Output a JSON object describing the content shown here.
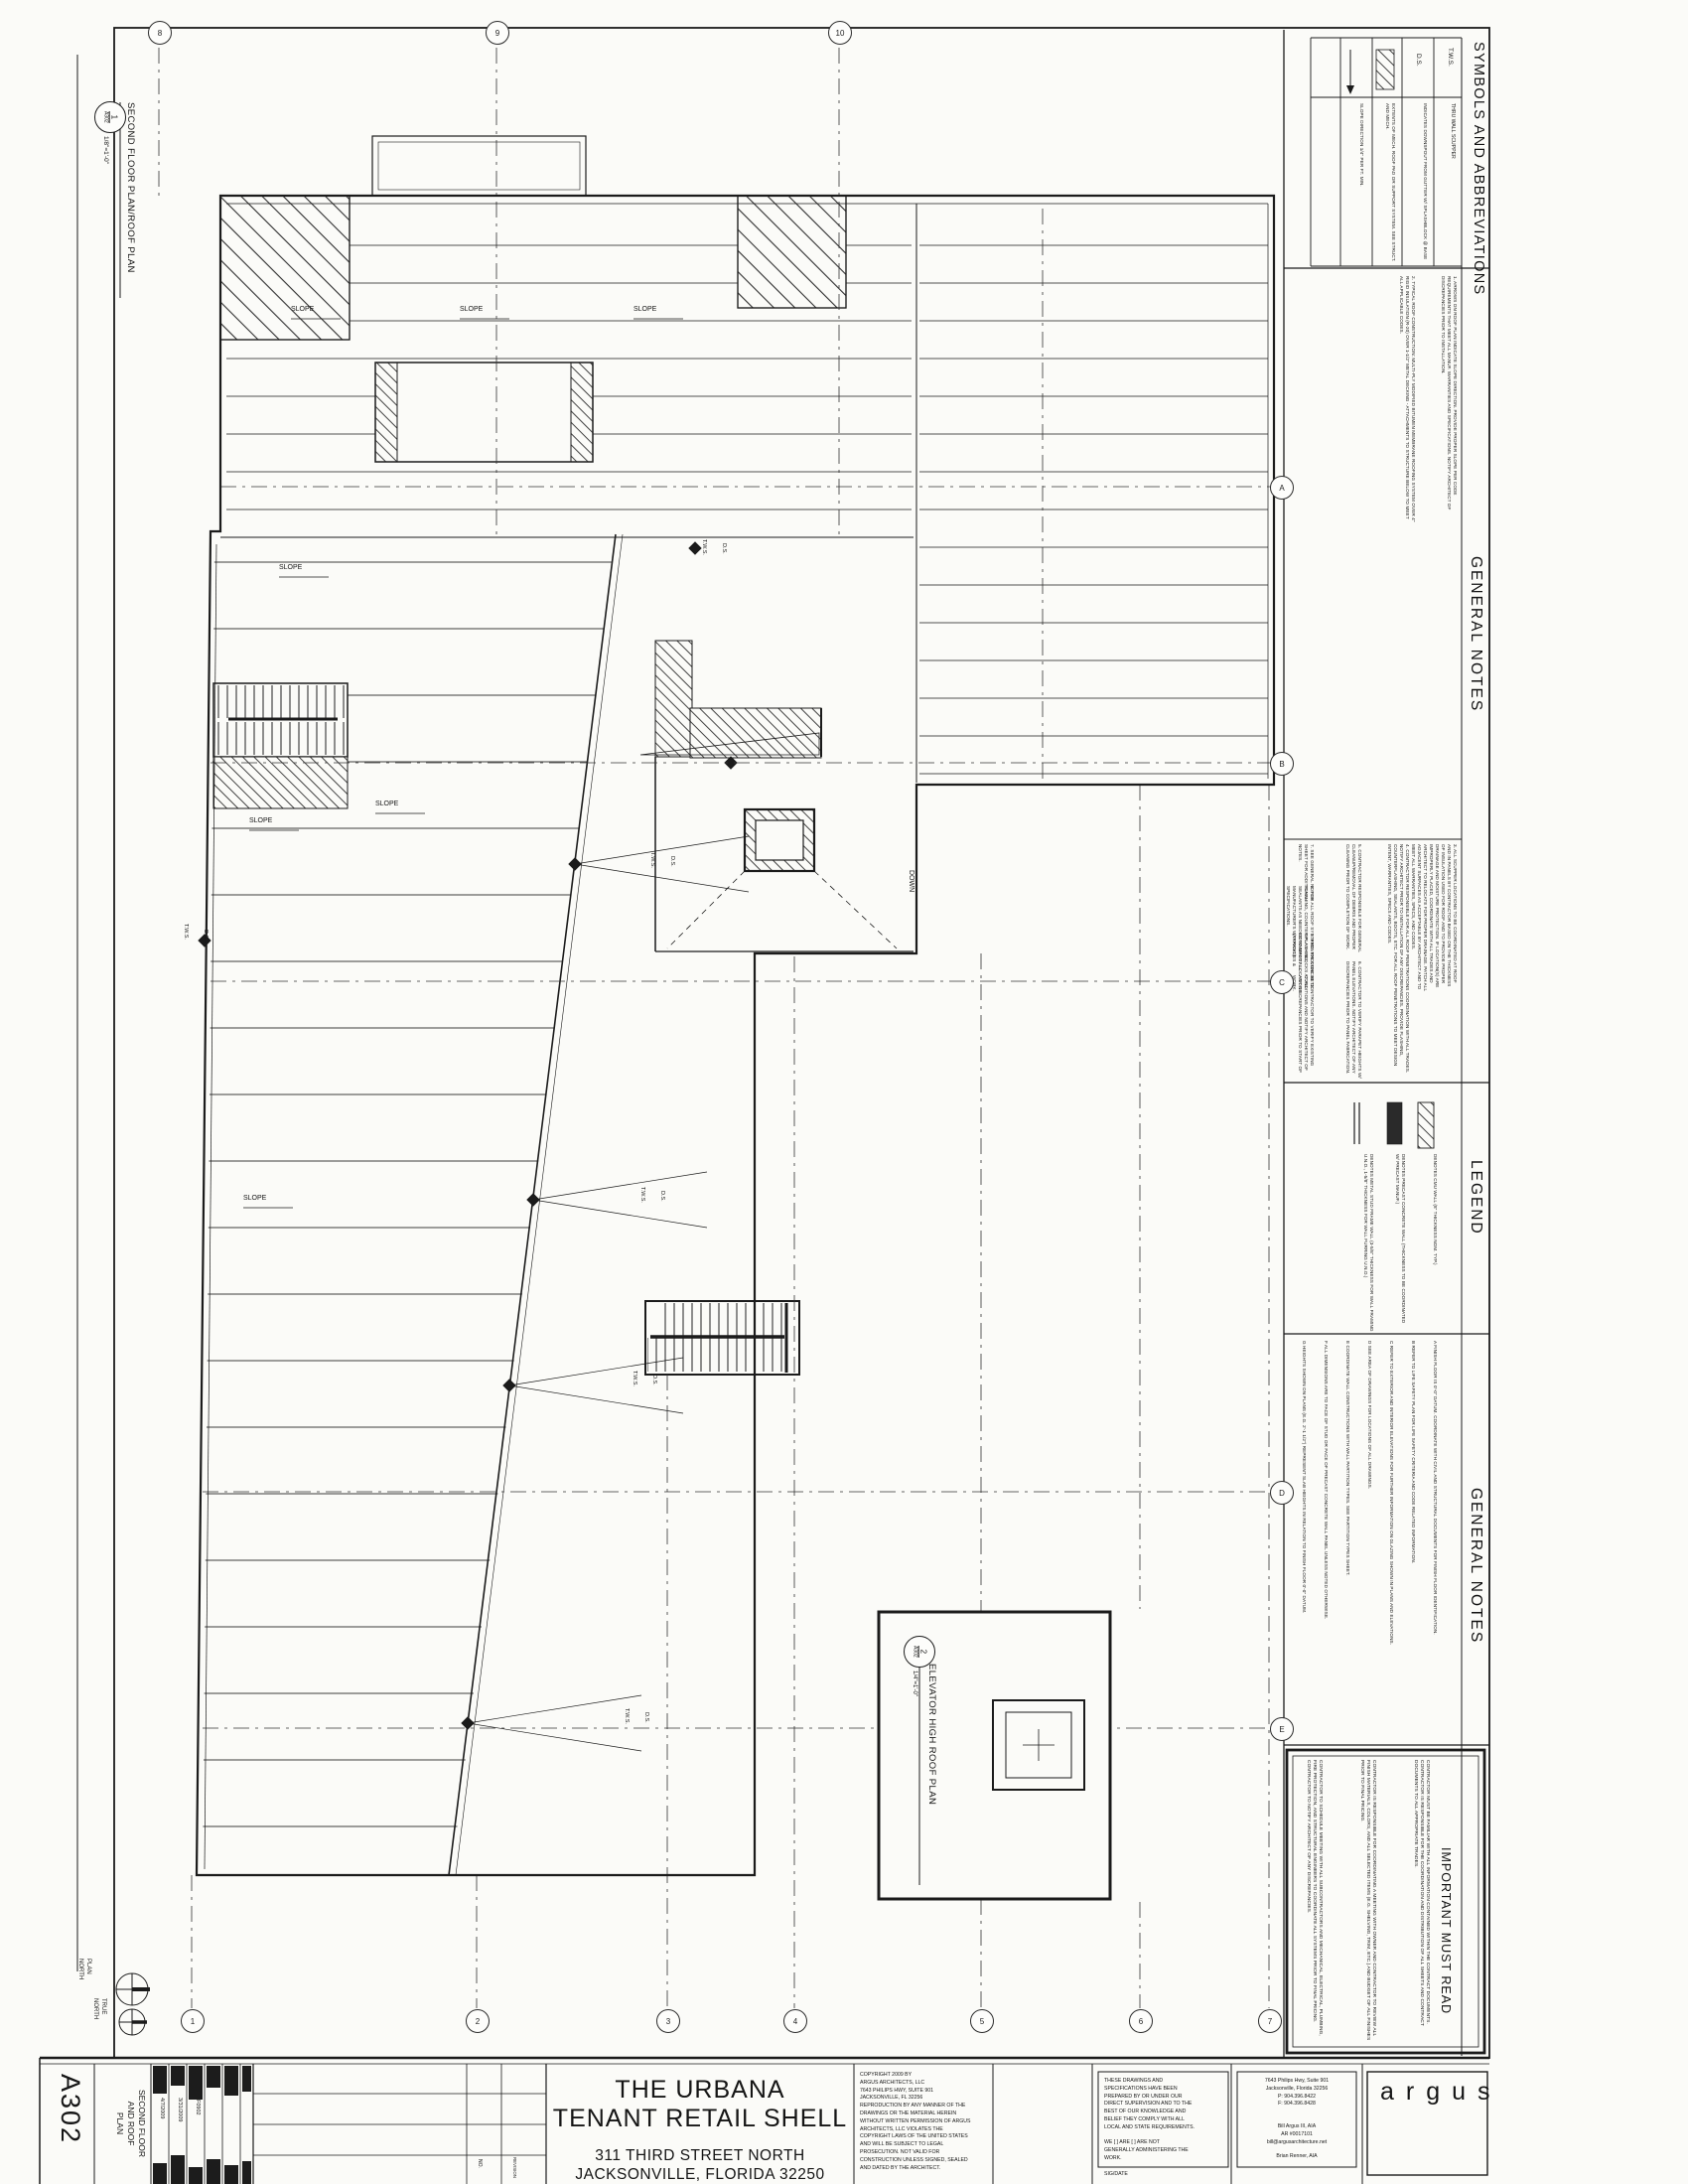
{
  "sheet_meta": {
    "sheet_number": "A302",
    "sheet_title": "SECOND FLOOR\nAND ROOF\nPLAN",
    "date_1": "4/7/2009",
    "date_2": "3/31/2009",
    "project_number": "F0902",
    "rev_no_label": "NO.",
    "rev_label": "REVISION"
  },
  "project": {
    "title_line_1": "THE URBANA",
    "title_line_2": "TENANT RETAIL SHELL",
    "address_line_1": "311 THIRD STREET NORTH",
    "address_line_2": "JACKSONVILLE, FLORIDA 32250"
  },
  "firm": {
    "logo": "argus",
    "address": "7643 Philips Hwy, Suite 901\nJacksonville, Florida 32256\nP: 904.396.8422\nF: 904.396.8428",
    "principal": "Bill Argus III, AIA\nAR #0017101\nbill@argusarchitecture.net",
    "associate": "Brian Renner, AIA",
    "copyright": "COPYRIGHT 2009 BY\nARGUS ARCHITECTS, LLC\n7643 PHILIPS HWY, SUITE 901\nJACKSONVILLE, FL  32256\nREPRODUCTION BY ANY MANNER OF THE\nDRAWINGS OR THE MATERIAL HEREIN\nWITHOUT WRITTEN PERMISSION OF ARGUS\nARCHITECTS, LLC VIOLATES THE\nCOPYRIGHT LAWS OF THE UNITED STATES\nAND WILL BE SUBJECT TO LEGAL\nPROSECUTION.  NOT VALID FOR\nCONSTRUCTION UNLESS SIGNED, SEALED\nAND DATED BY THE ARCHITECT.",
    "certification": "THESE DRAWINGS AND\nSPECIFICATIONS HAVE BEEN\nPREPARED BY OR UNDER OUR\nDIRECT SUPERVISION AND TO THE\nBEST OF OUR KNOWLEDGE AND\nBELIEF THEY COMPLY WITH ALL\nLOCAL AND STATE REQUIREMENTS.\n\nWE [    ] ARE [    ] ARE NOT\nGENERALLY ADMINISTERING THE\nWORK.\n\nSIG/DATE"
  },
  "drawing_titles": {
    "main": {
      "number": "1",
      "sheet": "A302",
      "title": "SECOND FLOOR PLAN/ROOF PLAN",
      "scale": "1/8\"=1'-0\""
    },
    "elevator": {
      "number": "2",
      "sheet": "A302",
      "title": "ELEVATOR HIGH ROOF PLAN",
      "scale": "1/4\"=1'-0\""
    }
  },
  "plan_labels": {
    "slope": "SLOPE",
    "tws": "T.W.S.",
    "ds": "D.S.",
    "down": "DOWN",
    "plan_north": "PLAN\nNORTH",
    "true_north": "TRUE\nNORTH"
  },
  "symbols": {
    "header": "SYMBOLS AND ABBREVIATIONS",
    "rows": [
      {
        "symbol": "T.W.S.",
        "desc": "THRU WALL SCUPPER"
      },
      {
        "symbol": "D.S.",
        "desc": "INDICATES DOWNSPOUT FROM GUTTER W/ SPLASHBLOCK @ BASE"
      },
      {
        "symbol": "mech-pad-hatch",
        "desc": "EXTENTS OF MECH. ROOF PAD OR SUPPORT SYSTEM. SEE STRUCT. AND MECH."
      },
      {
        "symbol": "slope-arrow",
        "desc": "SLOPE DIRECTION 1/4\" PER FT. MIN."
      }
    ]
  },
  "roof_notes": {
    "header": "GENERAL NOTES",
    "items": [
      "1.  ARROWS ON ROOF PLAN INDICATE SLOPE DIRECTION.  PROVIDE PROPER SLOPE PER CODE REQUIREMENTS THAT MEET ALL MANUF. WARRANTIES AND SPECIFICATIONS.  NOTIFY ARCHITECT OF DISCREPANCIES PRIOR TO INSTALLATION.",
      "2.  TYPICAL ROOF CONSTRUCTION:  MULTI-PLY MODIFIED BITUMEN MEMBRANE ROOFING SYSTEM OVER 4\" RIGID INSULATION (R-20) OVER 1-1/2\" METAL DECKING - ATTACHMENTS TO STRUCTURE BELOW TO MEET ALL APPLICABLE CODES.",
      "3.  ALL SCUPPER LOCATIONS TO BE COORDINATED AT ROOF AND IN PANELS BY CONTRACTOR BASED ON THE THICKNESS OF INSULATION USED FOR ROOF AND TO PROVIDE PROPER DRAINAGE AND MOISTURE PROTECTION.  IF LOCATION(S) ARE IMPROPERLY PLACED, COORDINATE WITH ALL TRADES AND ARCHITECT TO RELOCATE FOR PROPER DRAINAGE.  PATCH ALL ADJACENT SURFACES AS ACCEPTABLE BY ARCHITECT AND TO MEET ALL WARRANTIES, SPECS, AND CODES.",
      "4.  CONTRACTOR RESPONSIBLE FOR ALL ROOF PENETRATIONS COORDINATION WITH ALL TRADES.  NOTIFY ARCHITECT PRIOR TO INSTALLATION OF ANY DISCREPANCIES.  PROVIDE FLASHING, COUNTERFLASHING, SEALANTS, BOOTS, ETC. FOR ALL ROOF PENETRATIONS TO MEET DESIGN INTENT, WARRANTIES, SPECS AND CODES.",
      "5.  CONTRACTOR RESPONSIBLE FOR GENERAL CLEANUP/REMOVAL OF DEBRIS AND PROPER CLEANING PRIOR TO COMPLETION OF WORK.",
      "6.  CONTRACTOR TO VERIFY PARAPET HEIGHTS W/ PANEL ELEVATIONS.  NOTIFY ARCHITECT OF ANY DISCREPANCIES PRIOR TO PANEL FABRICATION.",
      "7.  SEE GENERAL NOTES SHEET FOR ADDITIONAL NOTES.",
      "8.  FOR ALL ROOF SYSTEMS:  PROVIDE FLASHING, COUNTER-FLASHING, SEALANTS AS NEEDED TO MEET ALL MANUFACTURER'S WARRANTIES & SPECIFICATIONS.",
      "9.  PROVIDE CONCRETE SPLASH BLOCKS AT ALL DOWNSPOUT LOCATIONS (TYPICAL).",
      "10.  CONTRACTOR TO VERIFY EXISTING CONDITIONS AND NOTIFY ARCHITECT OF ANY DISCREPANCIES PRIOR TO START OF WORK."
    ]
  },
  "legend": {
    "header": "LEGEND",
    "items": [
      "DENOTES CMU WALL (8\" THICKNESS NOM. TYP.)",
      "DENOTES PRECAST CONCRETE WALL (THICKNESS TO BE COORDINATED W/ PRECAST MANUF.)",
      "DENOTES METAL STUD FRAME WALL (3-5/8\" THICKNESS FOR WALL FRAMING U.N.O., 1-5/8\" THICKNESS FOR WALL FURRING U.N.O.)"
    ]
  },
  "plan_notes": {
    "header": "GENERAL NOTES",
    "items": [
      "A   FINISH FLOOR IS 0'-0\" DATUM.  COORDINATE WITH CIVIL AND STRUCTURAL DOCUMENTS FOR FINISH FLOOR IDENTIFICATION.",
      "B   REFER TO LIFE SAFETY PLAN FOR LIFE SAFETY CRITERIA AND CODE RELATED INFORMATION.",
      "C   REFER TO EXTERIOR AND INTERIOR ELEVATIONS FOR FURTHER INFORMATION ON GLAZING SHOWN IN PLANS AND ELEVATIONS.",
      "D   SEE AREA OF DRAWINGS FOR LOCATIONS OF ALL DRAWINGS.",
      "E   COORDINATE WALL CONSTRUCTIONS WITH WALL PARTITION TYPES.  SEE PARTITION TYPES SHEET.",
      "F   ALL DIMENSIONS ARE TO FACE OF STUD OR FACE OF PRECAST CONCRETE WALL PANEL UNLESS NOTED OTHERWISE.",
      "G   HEIGHTS SHOWN ON PLANS (E.G. 2'-1 1/2\") REPRESENT SLAB HEIGHTS IN RELATION TO FINISH FLOOR 0'-0\" DATUM."
    ]
  },
  "important": {
    "header": "IMPORTANT MUST READ",
    "paragraphs": [
      "CONTRACTOR MUST BE FAMILIAR WITH ALL INFORMATION CONTAINED WITHIN THE CONTRACT DOCUMENTS.  CONTRACTOR IS RESPONSIBLE FOR THE COORDINATION AND DISTRIBUTION OF ALL SHEETS AND CONTRACT DOCUMENTS TO ALL APPROPRIATE TRADES.",
      "CONTRACTOR IS RESPONSIBLE FOR COORDINATING A MEETING WITH OWNER AND CONTRACTOR TO REVIEW ALL FINISH MATERIALS, COLORS, AND ALL SELECTED ITEMS (E.G. SHELVING, TRIM, ETC.) AND BUDGET OF ALL FINISHES PRIOR TO FINAL PRICING.",
      "CONTRACTOR TO SCHEDULE MEETING WITH ALL SUBCONTRACTORS AND MECHANICAL, ELECTRICAL, PLUMBING, FIRE PROTECTION, AND STRUCTURAL ENGINEERS TO COORDINATE ALL SYSTEMS PRIOR TO FINAL PRICING.  CONTRACTOR TO NOTIFY ARCHITECT OF ANY DISCREPANCIES."
    ]
  },
  "grid_bubbles": {
    "top": [
      "8",
      "9",
      "10"
    ],
    "bottom": [
      "1",
      "2",
      "3",
      "4",
      "5",
      "6",
      "7"
    ],
    "right": [
      "A",
      "B",
      "C",
      "D",
      "E"
    ]
  }
}
